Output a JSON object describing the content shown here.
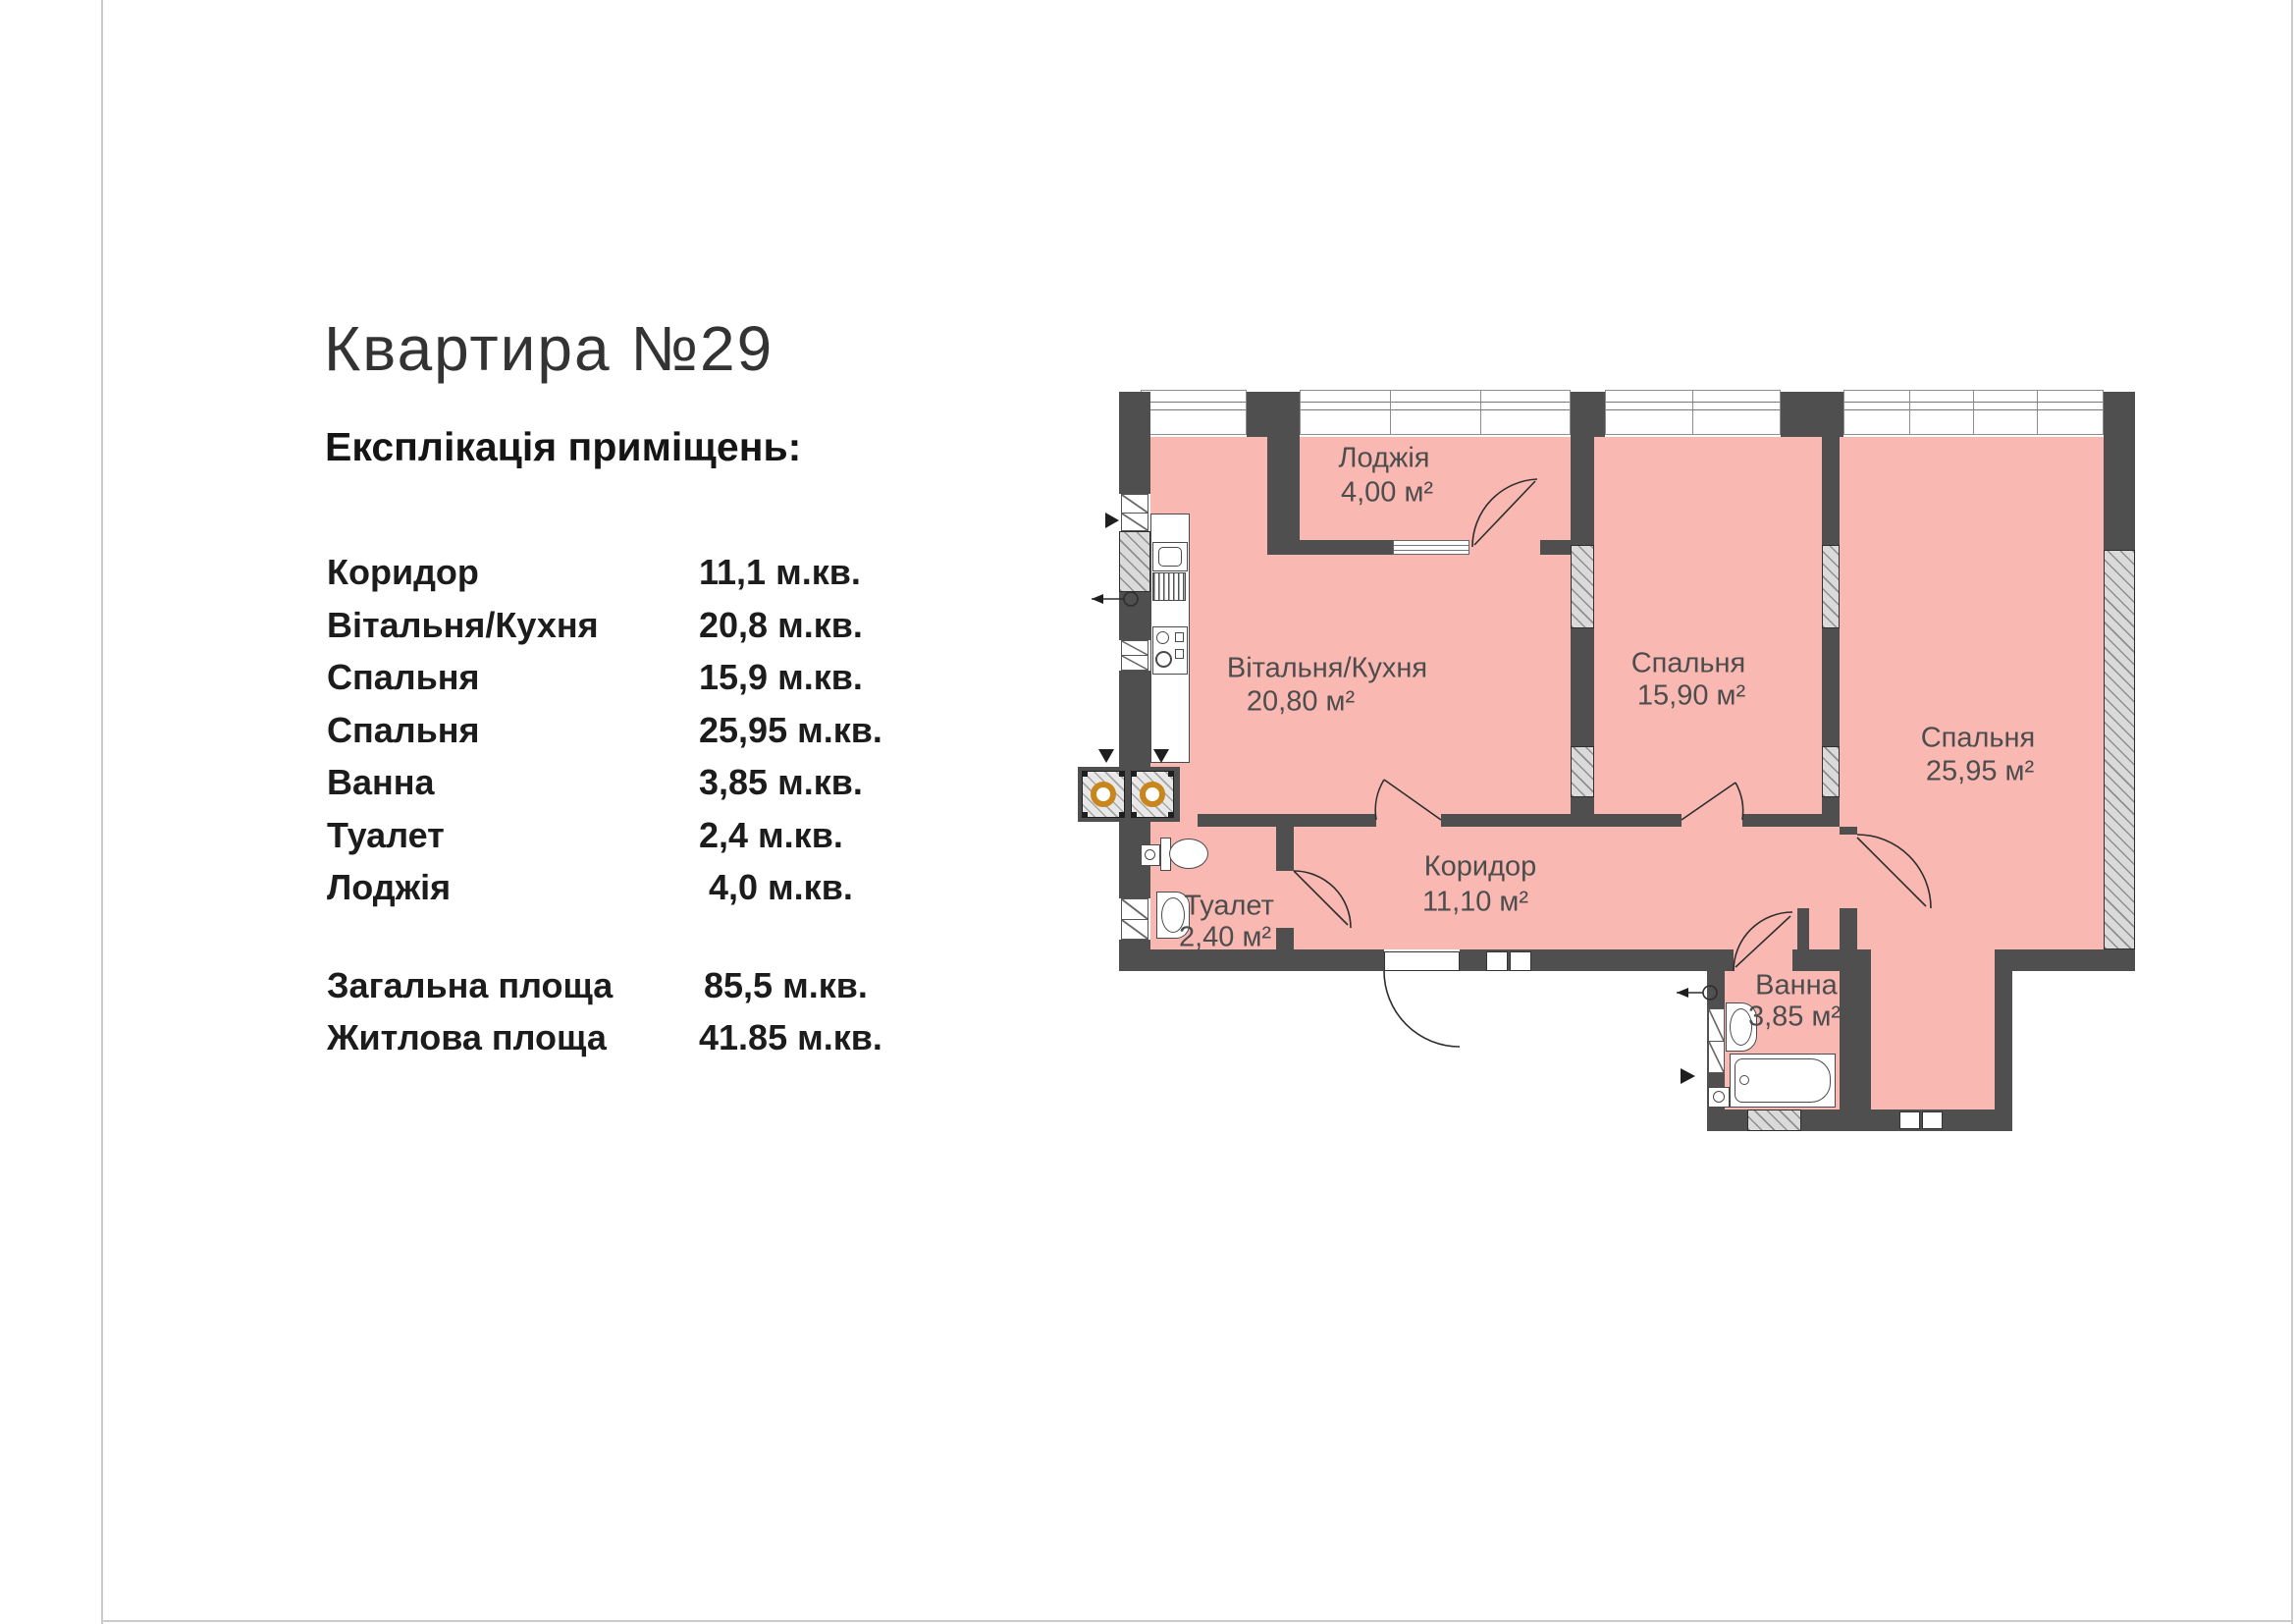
{
  "page": {
    "title": "Квартира №29",
    "subtitle": "Експлікація приміщень:"
  },
  "legend": {
    "rows": [
      {
        "label": "Коридор",
        "value": "11,1 м.кв."
      },
      {
        "label": "Вітальня/Кухня",
        "value": "20,8 м.кв."
      },
      {
        "label": "Спальня",
        "value": "15,9 м.кв."
      },
      {
        "label": "Спальня",
        "value": "25,95 м.кв."
      },
      {
        "label": "Ванна",
        "value": "3,85 м.кв."
      },
      {
        "label": "Туалет",
        "value": "2,4 м.кв."
      },
      {
        "label": "Лоджія",
        "value": "4,0 м.кв."
      }
    ],
    "summary": [
      {
        "label": "Загальна площа",
        "value": "85,5 м.кв."
      },
      {
        "label": "Житлова площа",
        "value": "41.85 м.кв."
      }
    ]
  },
  "plan": {
    "rooms": [
      {
        "id": "loggia",
        "name": "Лоджія",
        "area": "4,00 м²"
      },
      {
        "id": "living-kitchen",
        "name": "Вітальня/Кухня",
        "area": "20,80 м²"
      },
      {
        "id": "bedroom-1",
        "name": "Спальня",
        "area": "15,90 м²"
      },
      {
        "id": "bedroom-2",
        "name": "Спальня",
        "area": "25,95 м²"
      },
      {
        "id": "corridor",
        "name": "Коридор",
        "area": "11,10 м²"
      },
      {
        "id": "toilet",
        "name": "Туалет",
        "area": "2,40 м²"
      },
      {
        "id": "bathroom",
        "name": "Ванна",
        "area": "3,85 м²"
      }
    ]
  },
  "colors": {
    "room_fill": "#f9b9b2",
    "wall": "#4f4f4f",
    "vent_ring": "#c8861c",
    "text": "#1c1c1c"
  }
}
